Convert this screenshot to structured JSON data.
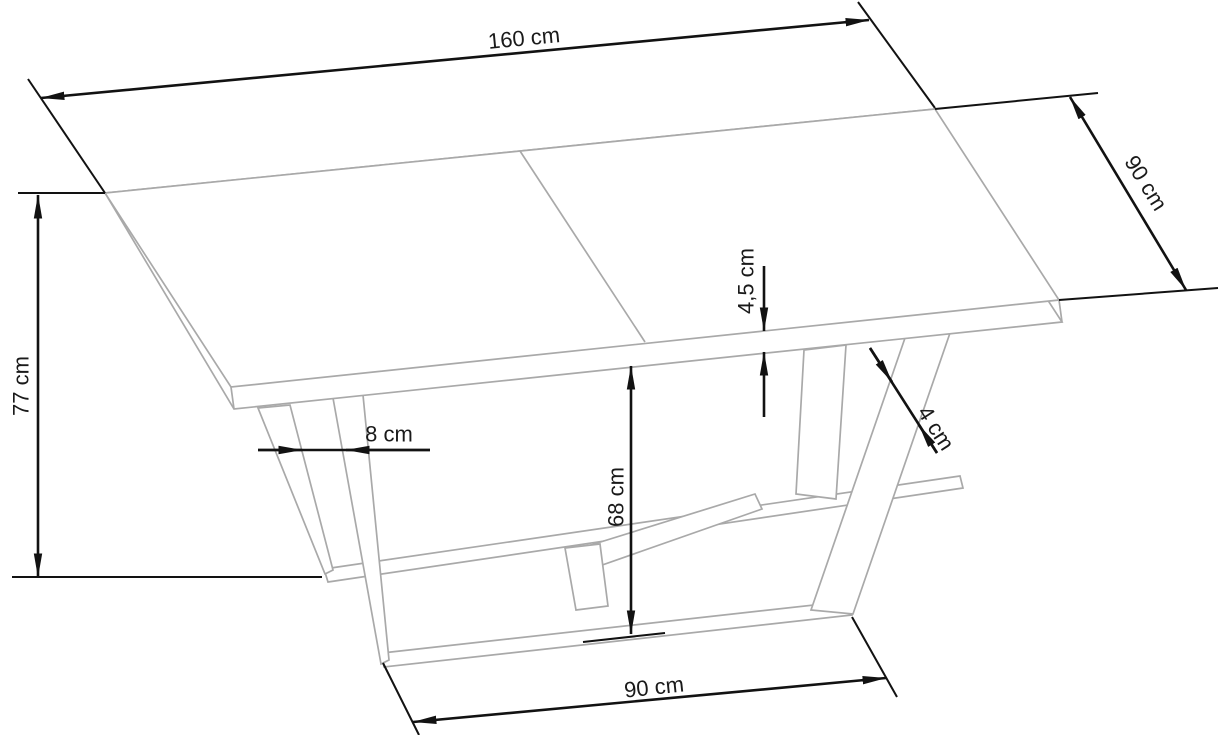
{
  "diagram": {
    "subject": "extendable-dining-table-dimension-drawing",
    "colors": {
      "background": "#ffffff",
      "dimension_lines": "#121212",
      "label_text": "#1a1a1a",
      "table_outline": "#a9a9a9"
    },
    "dimensions": {
      "table_length": {
        "label": "160 cm",
        "value": 160,
        "unit": "cm"
      },
      "table_depth": {
        "label": "90 cm",
        "value": 90,
        "unit": "cm"
      },
      "table_height": {
        "label": "77 cm",
        "value": 77,
        "unit": "cm"
      },
      "top_thickness": {
        "label": "4,5 cm",
        "value": 4.5,
        "unit": "cm"
      },
      "leg_thickness": {
        "label": "4 cm",
        "value": 4,
        "unit": "cm"
      },
      "leg_spacing": {
        "label": "8 cm",
        "value": 8,
        "unit": "cm"
      },
      "clearance": {
        "label": "68 cm",
        "value": 68,
        "unit": "cm"
      },
      "base_length": {
        "label": "90 cm",
        "value": 90,
        "unit": "cm"
      }
    }
  }
}
